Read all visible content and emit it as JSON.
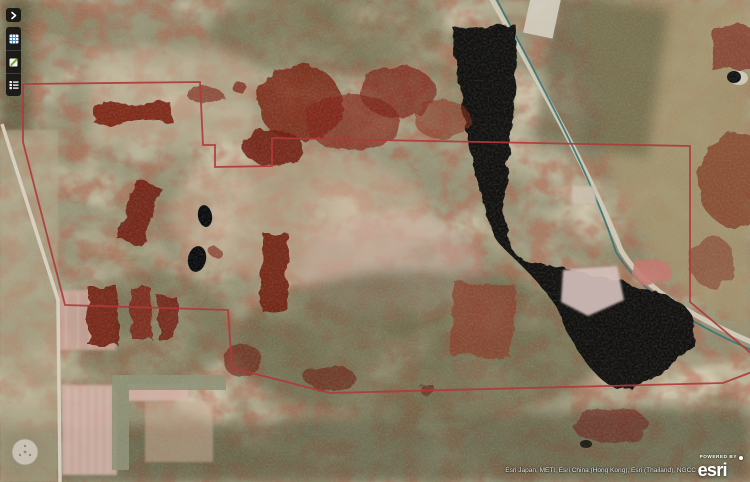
{
  "map": {
    "parcel_boundary": {
      "points": "23,84 200,82 203,145 215,145 215,167 272,166 272,138 690,146 690,302 752,354 752,372 723,383 330,393 232,368 228,310 65,305 23,142 23,84",
      "color": "#b03a3c"
    },
    "water_color": "#0a0b10",
    "stream_color": "#2f7276",
    "road_color": "#d6cfbf",
    "infrared_vegetation_color": "#7a1f12"
  },
  "toolbar": {
    "buttons": [
      {
        "id": "collapse",
        "icon": "chevron-right-icon"
      },
      {
        "id": "basemap",
        "icon": "basemap-icon"
      },
      {
        "id": "edit",
        "icon": "edit-pencil-icon"
      },
      {
        "id": "legend",
        "icon": "legend-list-icon"
      }
    ]
  },
  "attribution": {
    "sources": "Esri Japan, METI, Esri China (Hong Kong), Esri (Thailand), NGCC"
  },
  "branding": {
    "powered_by": "POWERED BY",
    "logo_text": "esri"
  }
}
